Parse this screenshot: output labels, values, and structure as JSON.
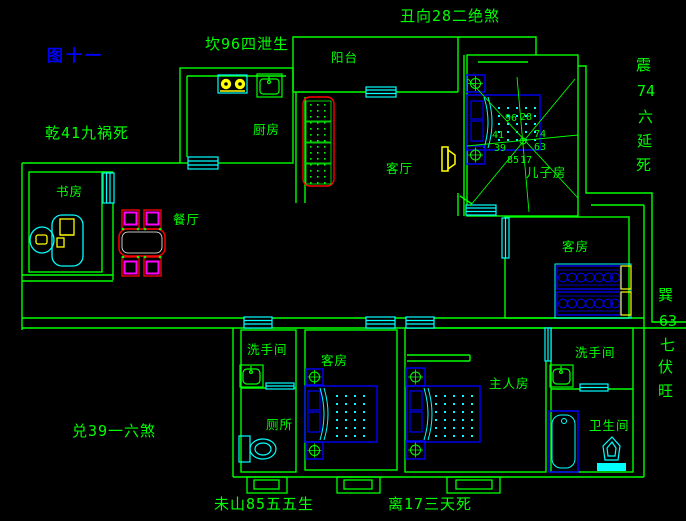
{
  "figure": {
    "label": "图十一"
  },
  "annotations": {
    "top": "丑向28二绝煞",
    "top_left": "坎96四泄生",
    "west_upper": "乾41九祸死",
    "west_lower": "兑39一六煞",
    "south_left": "未山85五五生",
    "south_right": "离17三天死",
    "east_upper": [
      "震",
      "74",
      "六",
      "延",
      "死"
    ],
    "east_lower": [
      "巽",
      "63",
      "七",
      "伏",
      "旺"
    ]
  },
  "rooms": {
    "balcony": "阳台",
    "kitchen": "厨房",
    "dining": "餐厅",
    "study": "书房",
    "living": "客厅",
    "son_bedroom": "儿子房",
    "guest_bedroom_east": "客房",
    "guest_bedroom_mid": "客房",
    "washroom_west": "洗手间",
    "toilet_west": "厕所",
    "master_bedroom": "主人房",
    "washroom_east": "洗手间",
    "bathroom_east": "卫生间"
  },
  "compass": {
    "numbers": [
      "96",
      "28",
      "41",
      "74",
      "39",
      "63",
      "85",
      "17"
    ]
  },
  "colors": {
    "wall": "#00ff00",
    "window": "#00ffff",
    "furniture_blue": "#0000ff",
    "accent_red": "#ff0000",
    "accent_magenta": "#ff00ff",
    "accent_yellow": "#ffff00",
    "figure_label_blue": "#0000ff",
    "background": "#000000"
  }
}
